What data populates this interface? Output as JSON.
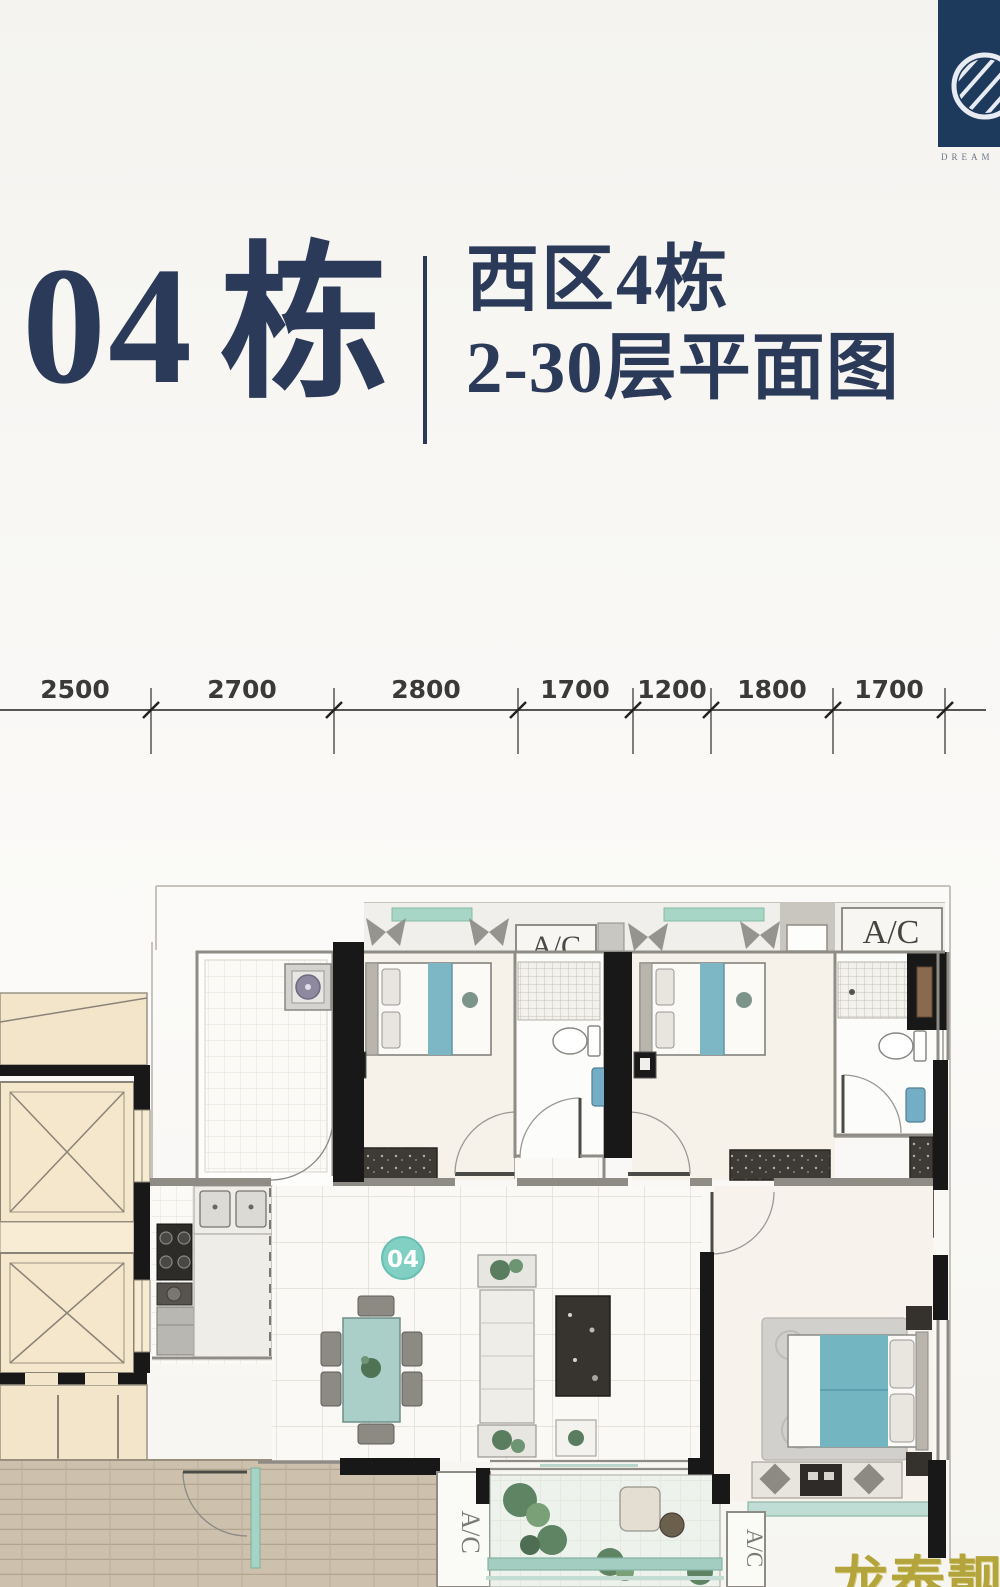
{
  "logo": {
    "caption": "DREAM"
  },
  "header": {
    "building_number": "04",
    "building_suffix": "栋",
    "subtitle_line1": "西区4栋",
    "subtitle_line2": "2-30层平面图"
  },
  "dimensions": {
    "values": [
      "2500",
      "2700",
      "2800",
      "1700",
      "1200",
      "1800",
      "1700"
    ]
  },
  "plan": {
    "unit_badge": "04",
    "ac_labels": {
      "top_middle": "A/C",
      "top_right": "A/C",
      "bottom_left": "A/C",
      "bottom_right": "A/C"
    }
  },
  "watermark": {
    "text": "龙泰靓房"
  },
  "colors": {
    "title_navy": "#2b3a58",
    "logo_navy": "#1d3a5c",
    "accent_teal": "#7ccdc1",
    "bed_teal": "#7db6c4",
    "watermark_gold": "#b3a43c"
  }
}
